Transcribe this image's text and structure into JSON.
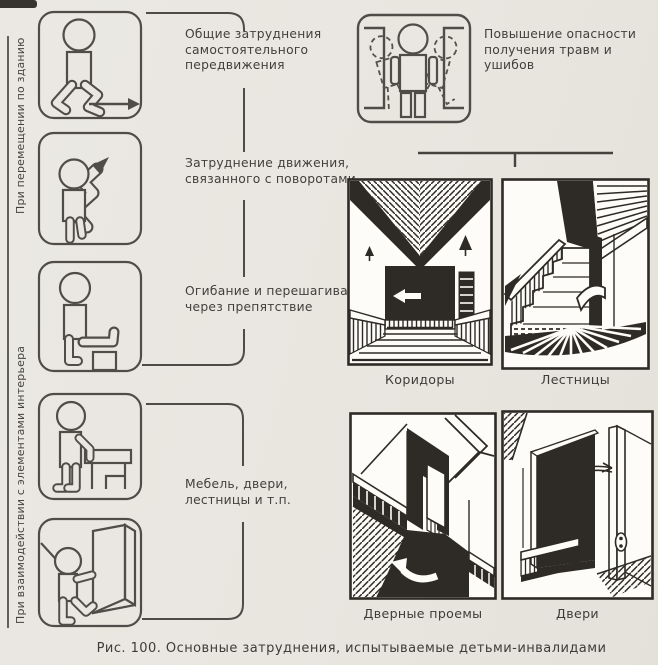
{
  "colors": {
    "paper": "#e9e6e0",
    "ink": "#2e2a26",
    "picto_line": "#504d48",
    "text": "#413f3b"
  },
  "groups": [
    {
      "axis_label": "При перемещении по зданию",
      "items": [
        {
          "icon": "walking-figure-pictogram",
          "label": "Общие затруднения\nсамостоятельного\nпередвижения"
        },
        {
          "icon": "turning-figure-pictogram",
          "label": "Затруднение движения,\nсвязанного с поворотами"
        },
        {
          "icon": "stepping-over-obstacle-pictogram",
          "label": "Огибание и перешагивание\nчерез препятствие"
        }
      ]
    },
    {
      "axis_label": "При взаимодействии с элементами интерьера",
      "items": [
        {
          "icon": "leaning-on-furniture-pictogram"
        },
        {
          "icon": "pushing-door-pictogram"
        }
      ],
      "label": "Мебель, двери,\nлестницы и т.п."
    }
  ],
  "hazard": {
    "icon": "figure-bumping-walls-pictogram",
    "label": "Повышение опасности\nполучения травм и ушибов"
  },
  "illustrations": [
    {
      "name": "corridors",
      "label": "Коридоры"
    },
    {
      "name": "stairs",
      "label": "Лестницы"
    },
    {
      "name": "doorways",
      "label": "Дверные проемы"
    },
    {
      "name": "doors",
      "label": "Двери"
    }
  ],
  "caption": "Рис. 100. Основные затруднения, испытываемые детьми-инвалидами"
}
